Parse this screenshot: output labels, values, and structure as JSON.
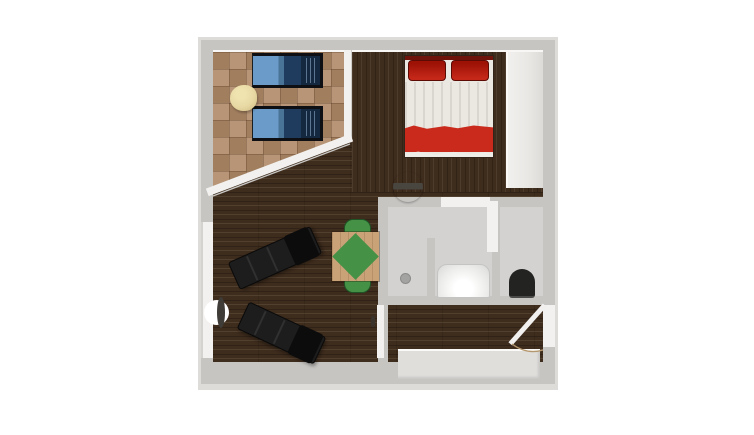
{
  "scene": {
    "type": "floor-plan-render",
    "description": "Top-down 3D rendered floor plan of a studio apartment with balcony, sleeping area, living area, bathroom with separate WC, and entry hall"
  },
  "rooms": {
    "balcony": {
      "label": "Balcony with light parquet floor"
    },
    "bedroom": {
      "label": "Sleeping area with dark wood floor"
    },
    "living": {
      "label": "Living area with dark wood floor"
    },
    "bathroom": {
      "label": "Bathroom with gray tile floor"
    },
    "wc": {
      "label": "Separate WC compartment"
    },
    "entry": {
      "label": "Entry area with gray floor"
    }
  },
  "furniture": {
    "bed": {
      "label": "Double bed with two red pillows, white duvet and red blanket"
    },
    "lounger1": {
      "label": "Blue sun lounger"
    },
    "lounger2": {
      "label": "Blue sun lounger"
    },
    "side_table": {
      "label": "Cream side table"
    },
    "wardrobe": {
      "label": "Built-in wardrobe"
    },
    "chaise1": {
      "label": "Black chaise lounge"
    },
    "chaise2": {
      "label": "Black chaise lounge"
    },
    "dining_table": {
      "label": "Wooden table with green diamond runner"
    },
    "chair_top": {
      "label": "Green chair"
    },
    "chair_bottom": {
      "label": "Green chair"
    },
    "bathtub": {
      "label": "White bathtub"
    },
    "toilet": {
      "label": "Black toilet"
    },
    "shower_drain": {
      "label": "Shower drain"
    },
    "door_bathroom": {
      "label": "Bathroom door"
    },
    "door_living": {
      "label": "Living room door on left wall"
    },
    "door_entry": {
      "label": "Entry door with swing arc"
    }
  },
  "colors": {
    "background": "#ffffff",
    "wall": "#c7c5c2",
    "wall_outer": "#dedcd9",
    "wall_white": "#f2f1ef",
    "wood_floor": "#3e2c1d",
    "parquet": "#af8966",
    "bath_floor": "#d3d2d0",
    "entry_floor": "#dfdedb",
    "wardrobe": "#e9e7e4",
    "bed_linen": "#ebe8e2",
    "bed_red": "#c92a1b",
    "pillow_red": "#9e1206",
    "lounger_blue": "#6b9bc8",
    "lounger_navy": "#1f3c5e",
    "chaise_black": "#1d1d1d",
    "table_wood": "#c9a278",
    "accent_green": "#459247",
    "side_table_cream": "#e8d9a4",
    "toilet_black": "#232321",
    "door_swing_arc": "#b5976d"
  }
}
